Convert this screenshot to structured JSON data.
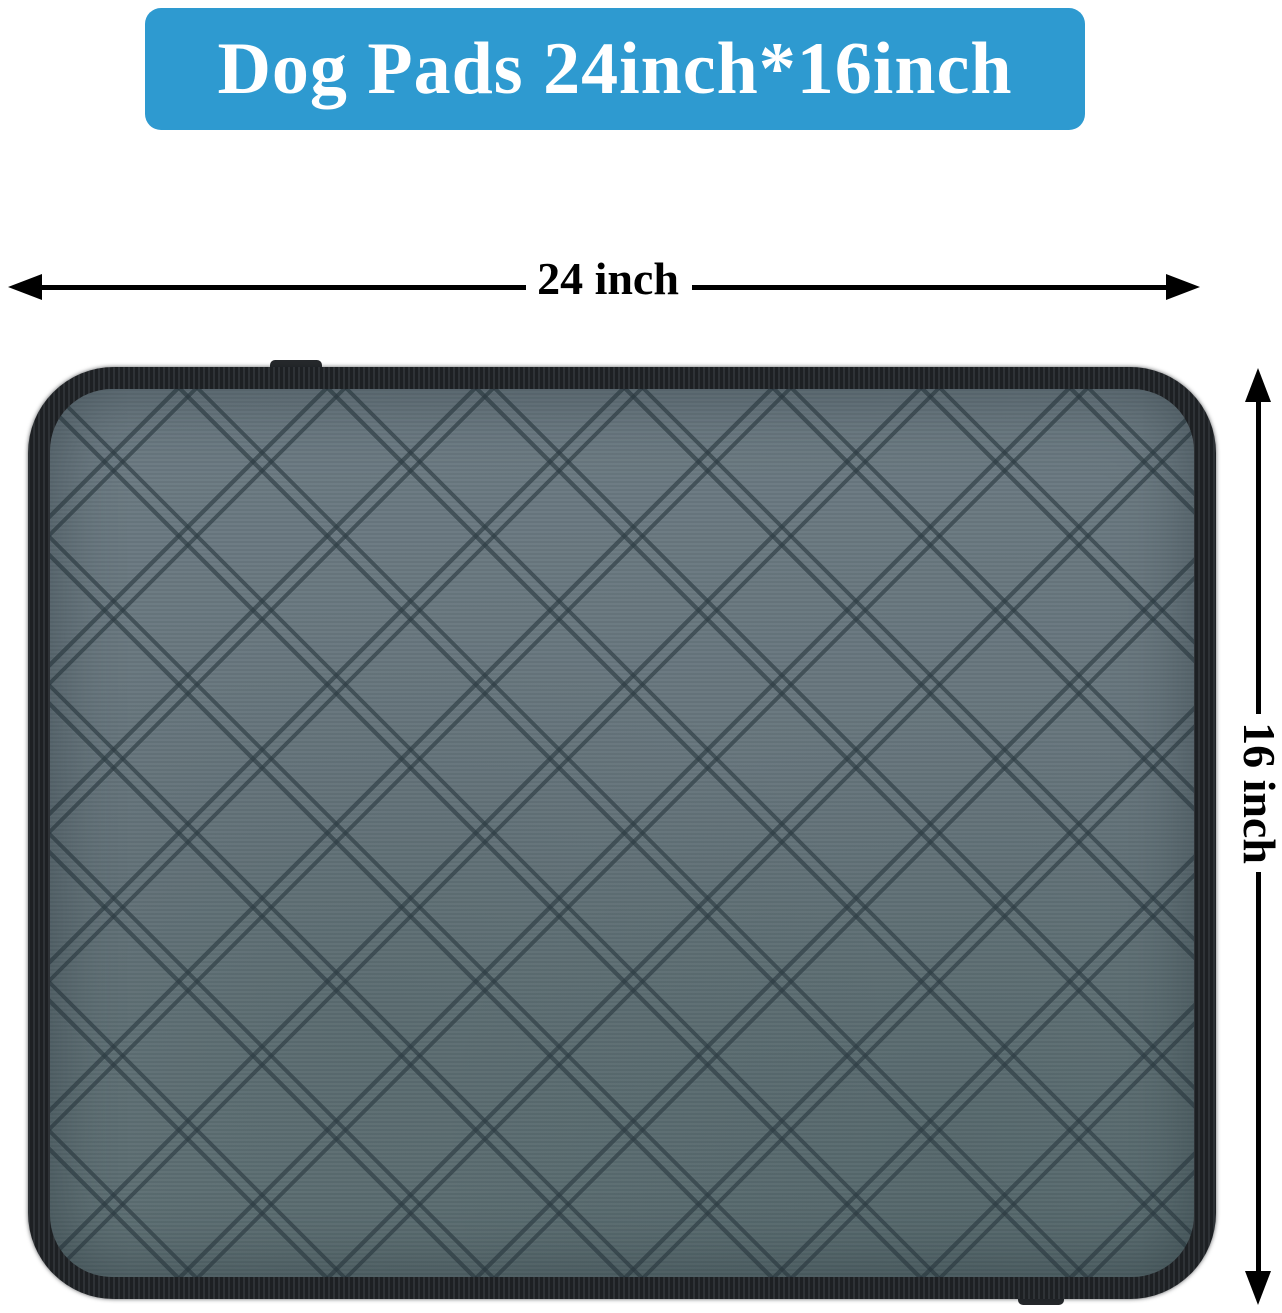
{
  "banner": {
    "label": "Dog Pads 24inch*16inch",
    "background_color": "#2E9AD0",
    "text_color": "#FFFFFF"
  },
  "dimension_annotations": {
    "width": {
      "label": "24 inch"
    },
    "height": {
      "label": "16 inch"
    },
    "line_color": "#000000"
  },
  "product": {
    "description": "Gray quilted waterproof dog pad with black binding and diamond double-stitch pattern",
    "fabric_color": "#66757C",
    "stitch_color": "#2E3D44",
    "binding_color": "#23272B"
  }
}
